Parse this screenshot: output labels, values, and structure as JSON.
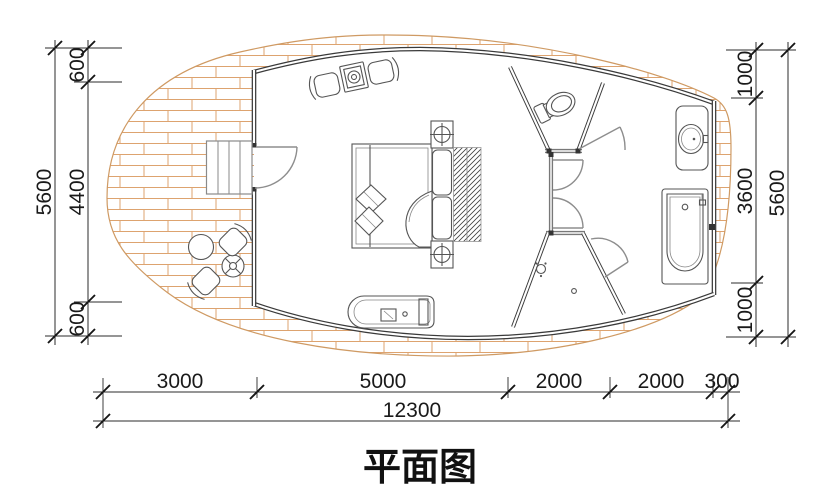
{
  "title": "平面图",
  "dimensions": {
    "left": {
      "overall": "5600",
      "segments": [
        "600",
        "4400",
        "600"
      ]
    },
    "right": {
      "overall": "5600",
      "segments": [
        "1000",
        "3600",
        "1000"
      ]
    },
    "bottom": {
      "overall": "12300",
      "segments": [
        "3000",
        "5000",
        "2000",
        "2000",
        "300"
      ]
    }
  },
  "colors": {
    "wall_line": "#3a3a3a",
    "partition_line": "#787878",
    "brick_line": "#dda36f",
    "dimension_line": "#2b2b2b",
    "text": "#1a1a1a",
    "background": "#ffffff"
  },
  "fixtures": [
    "entry-stairs",
    "entry-door",
    "double-bed",
    "nightstand-lamps",
    "headboard-hatch",
    "lounge-chairs-and-table",
    "bench-counter",
    "toilet",
    "shower",
    "floor-drain",
    "washbasin",
    "bathtub",
    "patio-round-table",
    "patio-side-table",
    "patio-chairs"
  ]
}
